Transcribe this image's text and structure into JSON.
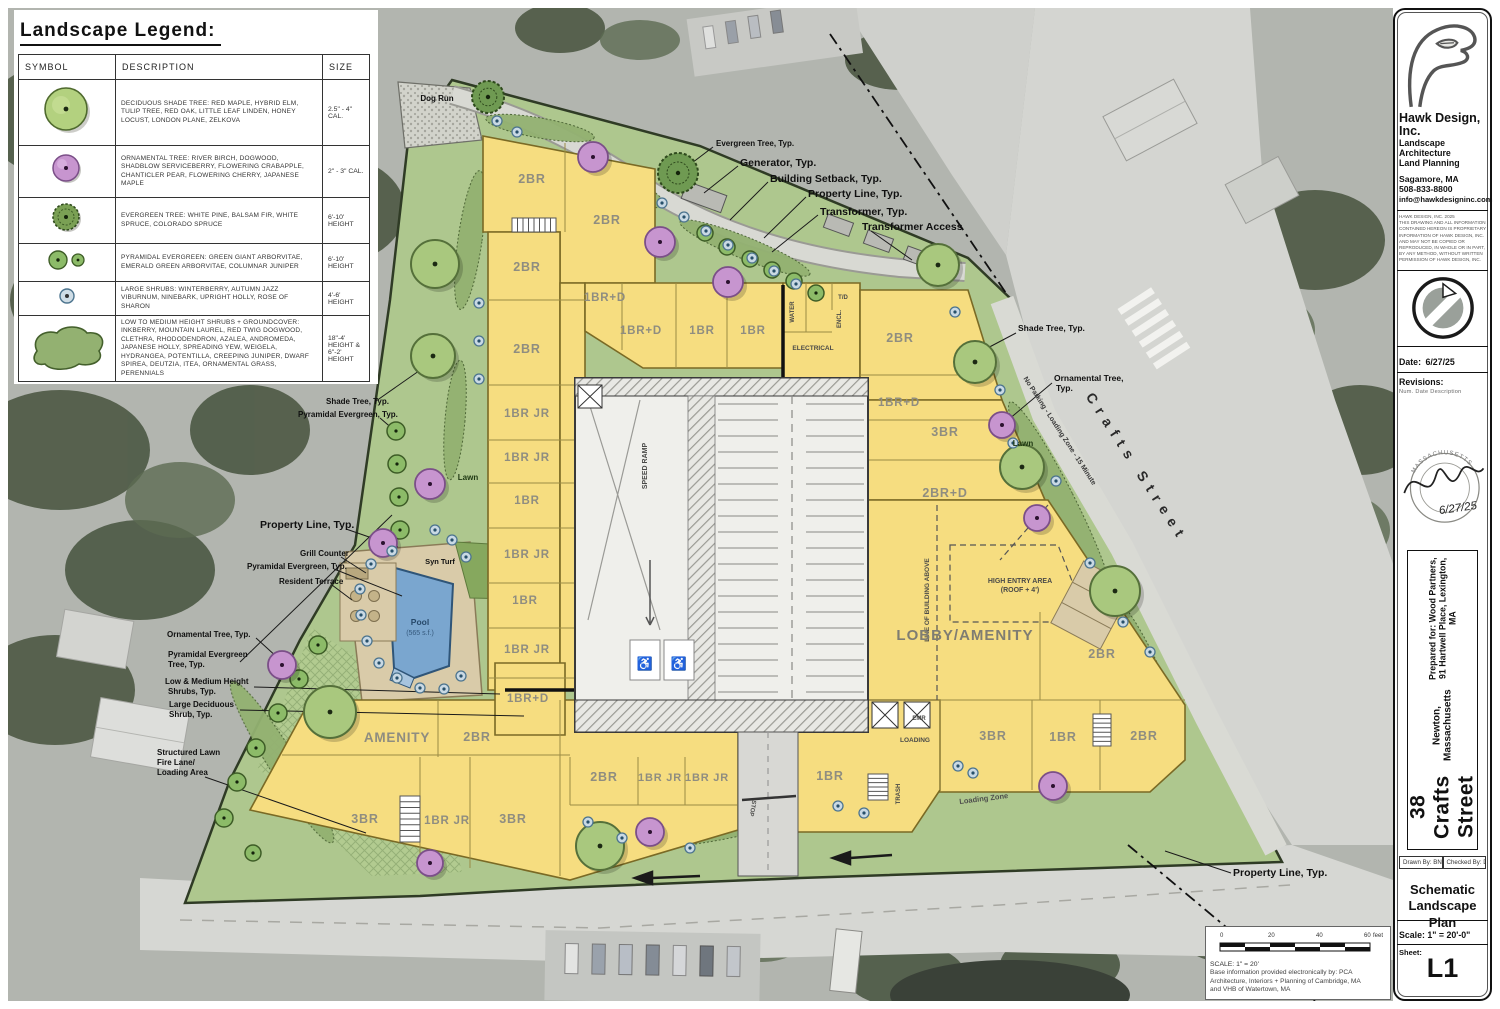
{
  "legend": {
    "title": "Landscape Legend:",
    "headers": [
      "SYMBOL",
      "DESCRIPTION",
      "SIZE"
    ],
    "rows": [
      {
        "desc": "DECIDUOUS SHADE TREE: RED MAPLE, HYBRID ELM, TULIP TREE, RED OAK, LITTLE LEAF LINDEN, HONEY LOCUST, LONDON PLANE, ZELKOVA",
        "size": "2.5\" - 4\" CAL."
      },
      {
        "desc": "ORNAMENTAL TREE: RIVER BIRCH, DOGWOOD, SHADBLOW SERVICEBERRY, FLOWERING CRABAPPLE, CHANTICLER PEAR, FLOWERING CHERRY, JAPANESE MAPLE",
        "size": "2\" - 3\" CAL."
      },
      {
        "desc": "EVERGREEN TREE: WHITE PINE, BALSAM FIR, WHITE SPRUCE, COLORADO SPRUCE",
        "size": "6'-10' HEIGHT"
      },
      {
        "desc": "PYRAMIDAL EVERGREEN: GREEN GIANT ARBORVITAE, EMERALD GREEN ARBORVITAE, COLUMNAR JUNIPER",
        "size": "6'-10' HEIGHT"
      },
      {
        "desc": "LARGE SHRUBS: WINTERBERRY, AUTUMN JAZZ VIBURNUM, NINEBARK, UPRIGHT HOLLY, ROSE OF SHARON",
        "size": "4'-6' HEIGHT"
      },
      {
        "desc": "LOW TO MEDIUM HEIGHT SHRUBS + GROUNDCOVER: INKBERRY, MOUNTAIN LAUREL, RED TWIG DOGWOOD, CLETHRA, RHODODENDRON, AZALEA, ANDROMEDA, JAPANESE HOLLY, SPREADING YEW, WEIGELA, HYDRANGEA, POTENTILLA, CREEPING JUNIPER, DWARF SPIREA, DEUTZIA, ITEA, ORNAMENTAL GRASS, PERENNIALS",
        "size": "18\"-4' HEIGHT & 6\"-2' HEIGHT"
      }
    ]
  },
  "titleblock": {
    "company": "Hawk Design, Inc.",
    "service1": "Landscape Architecture",
    "service2": "Land Planning",
    "city": "Sagamore, MA",
    "phone": "508-833-8800",
    "email": "info@hawkdesigninc.com",
    "copyright1": "HAWK DESIGN, INC. 2025",
    "copyright2": "THIS DRAWING AND ALL INFORMATION CONTAINED HEREON IS PROPRIETARY INFORMATION OF HAWK DESIGN, INC. AND MAY NOT BE COPIED OR REPRODUCED, IN WHOLE OR IN PART, BY ANY METHOD, WITHOUT WRITTEN PERMISSION OF HAWK DESIGN, INC.",
    "date_label": "Date:",
    "date": "6/27/25",
    "revisions_label": "Revisions:",
    "rev_cols": "Num.  Date    Description",
    "seal_state": "MASSACHUSETTS",
    "seal_date": "6/27/25",
    "project_title": "38 Crafts Street",
    "project_city": "Newton, Massachusetts",
    "prepared_for": "Prepared for: Wood Partners, 91 Hartwell Place, Lexington, MA",
    "drawn_by": "Drawn By: BNL",
    "checked_by": "Checked By: DH",
    "sheet_name1": "Schematic",
    "sheet_name2": "Landscape Plan",
    "scale": "Scale: 1\" = 20'-0\"",
    "sheet_label": "Sheet:",
    "sheet_number": "L1"
  },
  "scalebar": {
    "ticks": [
      "0",
      "20",
      "40",
      "60"
    ],
    "unit": "feet",
    "caption": "SCALE: 1\" = 20'",
    "note1": "Base information provided electronically by: PCA",
    "note2": "Architecture, Interiors + Planning of Cambridge, MA",
    "note3": "and VHB of Watertown, MA"
  },
  "colors": {
    "building_yellow": "#f6dd80",
    "site_green": "#aec78e",
    "pool_blue": "#7aa6cf",
    "ornamental_purple": "#c795cf",
    "shade_green": "#a9c87e",
    "evergreen_green": "#6f9a52",
    "shrub_blue": "#c9d9e4"
  },
  "plan": {
    "labels": [
      {
        "t": "Dog Run",
        "x": 437,
        "y": 101,
        "s": 8,
        "a": "middle"
      },
      {
        "t": "Evergreen Tree, Typ.",
        "x": 716,
        "y": 146,
        "s": 8
      },
      {
        "t": "Generator, Typ.",
        "x": 740,
        "y": 166,
        "s": 10.5
      },
      {
        "t": "Building Setback, Typ.",
        "x": 770,
        "y": 182,
        "s": 10.5
      },
      {
        "t": "Property Line, Typ.",
        "x": 808,
        "y": 197,
        "s": 10.5
      },
      {
        "t": "Transformer, Typ.",
        "x": 820,
        "y": 215,
        "s": 10.5
      },
      {
        "t": "Transformer Access",
        "x": 862,
        "y": 230,
        "s": 10.5
      },
      {
        "t": "Shade Tree, Typ.",
        "x": 1018,
        "y": 331,
        "s": 8.5
      },
      {
        "t": "Ornamental Tree,",
        "x": 1054,
        "y": 381,
        "s": 8.5
      },
      {
        "t": "Typ.",
        "x": 1056,
        "y": 391,
        "s": 8.5
      },
      {
        "t": "Lawn",
        "x": 1023,
        "y": 446,
        "s": 8,
        "cl": "lawn",
        "a": "middle"
      },
      {
        "t": "Shade Tree, Typ.",
        "x": 326,
        "y": 404,
        "s": 8
      },
      {
        "t": "Pyramidal Evergreen, Typ.",
        "x": 298,
        "y": 417,
        "s": 8
      },
      {
        "t": "Lawn",
        "x": 468,
        "y": 480,
        "s": 8,
        "cl": "lawn",
        "a": "middle"
      },
      {
        "t": "Property Line, Typ.",
        "x": 260,
        "y": 528,
        "s": 10.5
      },
      {
        "t": "Grill Counter",
        "x": 300,
        "y": 556,
        "s": 8
      },
      {
        "t": "Pyramidal Evergreen, Typ.",
        "x": 247,
        "y": 569,
        "s": 8
      },
      {
        "t": "Resident Terrace",
        "x": 279,
        "y": 584,
        "s": 8
      },
      {
        "t": "Ornamental Tree, Typ.",
        "x": 167,
        "y": 637,
        "s": 8
      },
      {
        "t": "Pyramidal Evergreen",
        "x": 168,
        "y": 657,
        "s": 8
      },
      {
        "t": "Tree, Typ.",
        "x": 168,
        "y": 667,
        "s": 8
      },
      {
        "t": "Low & Medium Height",
        "x": 165,
        "y": 684,
        "s": 8
      },
      {
        "t": "Shrubs, Typ.",
        "x": 168,
        "y": 694,
        "s": 8
      },
      {
        "t": "Large Deciduous",
        "x": 169,
        "y": 707,
        "s": 8
      },
      {
        "t": "Shrub, Typ.",
        "x": 169,
        "y": 717,
        "s": 8
      },
      {
        "t": "Structured Lawn",
        "x": 157,
        "y": 755,
        "s": 8
      },
      {
        "t": "Fire Lane/",
        "x": 157,
        "y": 765,
        "s": 8
      },
      {
        "t": "Loading Area",
        "x": 157,
        "y": 775,
        "s": 8
      },
      {
        "t": "Property Line, Typ.",
        "x": 1233,
        "y": 876,
        "s": 10.5
      },
      {
        "t": "Crafts Street",
        "x": 1133,
        "y": 470,
        "s": 14,
        "cl": "street",
        "r": 57,
        "ls": 7
      },
      {
        "t": "No Parking - Loading Zone - 15 Minute",
        "x": 1058,
        "y": 432,
        "s": 7,
        "cl": "curb",
        "r": 57
      },
      {
        "t": "Syn Turf",
        "x": 440,
        "y": 564,
        "s": 7.5,
        "a": "middle"
      },
      {
        "t": "Pool",
        "x": 420,
        "y": 625,
        "s": 8.5,
        "cl": "pool",
        "a": "middle"
      },
      {
        "t": "(565 s.f.)",
        "x": 420,
        "y": 635,
        "s": 7,
        "cl": "pool2",
        "a": "middle"
      },
      {
        "t": "SPEED RAMP",
        "x": 647,
        "y": 466,
        "s": 7,
        "cl": "room",
        "r": -90,
        "a": "middle"
      },
      {
        "t": "ELECTRICAL",
        "x": 813,
        "y": 350,
        "s": 6.5,
        "cl": "room",
        "a": "middle"
      },
      {
        "t": "WATER",
        "x": 794,
        "y": 312,
        "s": 6,
        "cl": "room",
        "r": -90,
        "a": "middle"
      },
      {
        "t": "T/D",
        "x": 843,
        "y": 299,
        "s": 6,
        "cl": "room",
        "a": "middle"
      },
      {
        "t": "ENCL.",
        "x": 841,
        "y": 319,
        "s": 6,
        "cl": "room",
        "r": -90,
        "a": "middle"
      },
      {
        "t": "EMR",
        "x": 919,
        "y": 720,
        "s": 6,
        "cl": "room",
        "a": "middle"
      },
      {
        "t": "LOADING",
        "x": 915,
        "y": 742,
        "s": 6.5,
        "cl": "room",
        "a": "middle"
      },
      {
        "t": "TRASH",
        "x": 900,
        "y": 794,
        "s": 6,
        "cl": "room",
        "r": -90,
        "a": "middle"
      },
      {
        "t": "HIGH ENTRY AREA",
        "x": 1020,
        "y": 583,
        "s": 7,
        "cl": "room",
        "a": "middle"
      },
      {
        "t": "(ROOF + 4')",
        "x": 1020,
        "y": 592,
        "s": 7,
        "cl": "room",
        "a": "middle"
      },
      {
        "t": "LINE OF BUILDING ABOVE",
        "x": 929,
        "y": 600,
        "s": 6.5,
        "cl": "room",
        "r": -90,
        "a": "middle"
      },
      {
        "t": "Loading Zone",
        "x": 984,
        "y": 801,
        "s": 7.5,
        "cl": "pave",
        "r": -7,
        "a": "middle"
      },
      {
        "t": "STOP",
        "x": 751,
        "y": 808,
        "s": 6,
        "cl": "pave",
        "r": 100,
        "a": "middle"
      },
      {
        "t": "2BR",
        "x": 532,
        "y": 183,
        "s": 12.5,
        "cl": "unit",
        "a": "middle"
      },
      {
        "t": "2BR",
        "x": 607,
        "y": 224,
        "s": 12.5,
        "cl": "unit",
        "a": "middle"
      },
      {
        "t": "2BR",
        "x": 527,
        "y": 271,
        "s": 12.5,
        "cl": "unit",
        "a": "middle"
      },
      {
        "t": "2BR",
        "x": 527,
        "y": 353,
        "s": 12.5,
        "cl": "unit",
        "a": "middle"
      },
      {
        "t": "1BR JR",
        "x": 527,
        "y": 417,
        "s": 11.5,
        "cl": "unit",
        "a": "middle"
      },
      {
        "t": "1BR JR",
        "x": 527,
        "y": 461,
        "s": 11.5,
        "cl": "unit",
        "a": "middle"
      },
      {
        "t": "1BR",
        "x": 527,
        "y": 504,
        "s": 11.5,
        "cl": "unit",
        "a": "middle"
      },
      {
        "t": "1BR JR",
        "x": 527,
        "y": 558,
        "s": 11.5,
        "cl": "unit",
        "a": "middle"
      },
      {
        "t": "1BR",
        "x": 525,
        "y": 604,
        "s": 11.5,
        "cl": "unit",
        "a": "middle"
      },
      {
        "t": "1BR JR",
        "x": 527,
        "y": 653,
        "s": 11.5,
        "cl": "unit",
        "a": "middle"
      },
      {
        "t": "1BR+D",
        "x": 528,
        "y": 702,
        "s": 11.5,
        "cl": "unit",
        "a": "middle"
      },
      {
        "t": "1BR+D",
        "x": 605,
        "y": 301,
        "s": 11.5,
        "cl": "unit",
        "a": "middle"
      },
      {
        "t": "1BR+D",
        "x": 641,
        "y": 334,
        "s": 11.5,
        "cl": "unit",
        "a": "middle"
      },
      {
        "t": "1BR",
        "x": 702,
        "y": 334,
        "s": 11.5,
        "cl": "unit",
        "a": "middle"
      },
      {
        "t": "1BR",
        "x": 753,
        "y": 334,
        "s": 11.5,
        "cl": "unit",
        "a": "middle"
      },
      {
        "t": "2BR",
        "x": 900,
        "y": 342,
        "s": 12.5,
        "cl": "unit",
        "a": "middle"
      },
      {
        "t": "1BR+D",
        "x": 899,
        "y": 406,
        "s": 11.5,
        "cl": "unit",
        "a": "middle"
      },
      {
        "t": "3BR",
        "x": 945,
        "y": 436,
        "s": 12.5,
        "cl": "unit",
        "a": "middle"
      },
      {
        "t": "2BR+D",
        "x": 945,
        "y": 497,
        "s": 12.5,
        "cl": "unit",
        "a": "middle"
      },
      {
        "t": "LOBBY/AMENITY",
        "x": 965,
        "y": 640,
        "s": 15,
        "cl": "unitbig",
        "a": "middle"
      },
      {
        "t": "2BR",
        "x": 1102,
        "y": 658,
        "s": 12.5,
        "cl": "unit",
        "a": "middle"
      },
      {
        "t": "AMENITY",
        "x": 397,
        "y": 742,
        "s": 13.5,
        "cl": "unit",
        "a": "middle"
      },
      {
        "t": "2BR",
        "x": 477,
        "y": 741,
        "s": 12.5,
        "cl": "unit",
        "a": "middle"
      },
      {
        "t": "3BR",
        "x": 365,
        "y": 823,
        "s": 12.5,
        "cl": "unit",
        "a": "middle"
      },
      {
        "t": "1BR JR",
        "x": 447,
        "y": 824,
        "s": 11.5,
        "cl": "unit",
        "a": "middle"
      },
      {
        "t": "3BR",
        "x": 513,
        "y": 823,
        "s": 12.5,
        "cl": "unit",
        "a": "middle"
      },
      {
        "t": "2BR",
        "x": 604,
        "y": 781,
        "s": 12.5,
        "cl": "unit",
        "a": "middle"
      },
      {
        "t": "1BR JR",
        "x": 660,
        "y": 781,
        "s": 11,
        "cl": "unit",
        "a": "middle"
      },
      {
        "t": "1BR JR",
        "x": 707,
        "y": 781,
        "s": 11,
        "cl": "unit",
        "a": "middle"
      },
      {
        "t": "1BR",
        "x": 830,
        "y": 780,
        "s": 12.5,
        "cl": "unit",
        "a": "middle"
      },
      {
        "t": "3BR",
        "x": 993,
        "y": 740,
        "s": 12.5,
        "cl": "unit",
        "a": "middle"
      },
      {
        "t": "1BR",
        "x": 1063,
        "y": 741,
        "s": 12.5,
        "cl": "unit",
        "a": "middle"
      },
      {
        "t": "2BR",
        "x": 1144,
        "y": 740,
        "s": 12.5,
        "cl": "unit",
        "a": "middle"
      }
    ],
    "trees": [
      {
        "t": "s",
        "x": 435,
        "y": 264,
        "r": 24
      },
      {
        "t": "s",
        "x": 433,
        "y": 356,
        "r": 22
      },
      {
        "t": "s",
        "x": 330,
        "y": 712,
        "r": 26
      },
      {
        "t": "s",
        "x": 600,
        "y": 846,
        "r": 24
      },
      {
        "t": "s",
        "x": 938,
        "y": 265,
        "r": 21
      },
      {
        "t": "s",
        "x": 975,
        "y": 362,
        "r": 21
      },
      {
        "t": "s",
        "x": 1022,
        "y": 467,
        "r": 22
      },
      {
        "t": "s",
        "x": 1115,
        "y": 591,
        "r": 25
      },
      {
        "t": "e",
        "x": 488,
        "y": 97,
        "r": 16
      },
      {
        "t": "e",
        "x": 678,
        "y": 173,
        "r": 20
      },
      {
        "t": "p",
        "x": 705,
        "y": 233,
        "r": 8
      },
      {
        "t": "p",
        "x": 727,
        "y": 247,
        "r": 8
      },
      {
        "t": "p",
        "x": 750,
        "y": 259,
        "r": 8
      },
      {
        "t": "p",
        "x": 772,
        "y": 270,
        "r": 8
      },
      {
        "t": "p",
        "x": 794,
        "y": 281,
        "r": 8
      },
      {
        "t": "p",
        "x": 816,
        "y": 293,
        "r": 8
      },
      {
        "t": "p",
        "x": 396,
        "y": 431,
        "r": 9
      },
      {
        "t": "p",
        "x": 397,
        "y": 464,
        "r": 9
      },
      {
        "t": "p",
        "x": 399,
        "y": 497,
        "r": 9
      },
      {
        "t": "p",
        "x": 400,
        "y": 530,
        "r": 9
      },
      {
        "t": "p",
        "x": 318,
        "y": 645,
        "r": 9
      },
      {
        "t": "p",
        "x": 299,
        "y": 679,
        "r": 9
      },
      {
        "t": "p",
        "x": 278,
        "y": 713,
        "r": 9
      },
      {
        "t": "p",
        "x": 256,
        "y": 748,
        "r": 9
      },
      {
        "t": "p",
        "x": 237,
        "y": 782,
        "r": 9
      },
      {
        "t": "p",
        "x": 224,
        "y": 818,
        "r": 9
      },
      {
        "t": "p",
        "x": 253,
        "y": 853,
        "r": 8
      },
      {
        "t": "o",
        "x": 593,
        "y": 157,
        "r": 15
      },
      {
        "t": "o",
        "x": 660,
        "y": 242,
        "r": 15
      },
      {
        "t": "o",
        "x": 728,
        "y": 282,
        "r": 15
      },
      {
        "t": "o",
        "x": 430,
        "y": 484,
        "r": 15
      },
      {
        "t": "o",
        "x": 383,
        "y": 543,
        "r": 14
      },
      {
        "t": "o",
        "x": 282,
        "y": 665,
        "r": 14
      },
      {
        "t": "o",
        "x": 1002,
        "y": 425,
        "r": 13
      },
      {
        "t": "o",
        "x": 1037,
        "y": 518,
        "r": 13
      },
      {
        "t": "o",
        "x": 650,
        "y": 832,
        "r": 14
      },
      {
        "t": "o",
        "x": 430,
        "y": 863,
        "r": 13
      },
      {
        "t": "o",
        "x": 1053,
        "y": 786,
        "r": 14
      },
      {
        "t": "b",
        "x": 497,
        "y": 121,
        "r": 5
      },
      {
        "t": "b",
        "x": 517,
        "y": 132,
        "r": 5
      },
      {
        "t": "b",
        "x": 662,
        "y": 203,
        "r": 5
      },
      {
        "t": "b",
        "x": 684,
        "y": 217,
        "r": 5
      },
      {
        "t": "b",
        "x": 706,
        "y": 231,
        "r": 5
      },
      {
        "t": "b",
        "x": 728,
        "y": 245,
        "r": 5
      },
      {
        "t": "b",
        "x": 752,
        "y": 258,
        "r": 5
      },
      {
        "t": "b",
        "x": 774,
        "y": 271,
        "r": 5
      },
      {
        "t": "b",
        "x": 796,
        "y": 284,
        "r": 5
      },
      {
        "t": "b",
        "x": 479,
        "y": 303,
        "r": 5
      },
      {
        "t": "b",
        "x": 479,
        "y": 341,
        "r": 5
      },
      {
        "t": "b",
        "x": 479,
        "y": 379,
        "r": 5
      },
      {
        "t": "b",
        "x": 392,
        "y": 551,
        "r": 5
      },
      {
        "t": "b",
        "x": 371,
        "y": 564,
        "r": 5
      },
      {
        "t": "b",
        "x": 360,
        "y": 589,
        "r": 5
      },
      {
        "t": "b",
        "x": 361,
        "y": 615,
        "r": 5
      },
      {
        "t": "b",
        "x": 367,
        "y": 641,
        "r": 5
      },
      {
        "t": "b",
        "x": 379,
        "y": 663,
        "r": 5
      },
      {
        "t": "b",
        "x": 397,
        "y": 678,
        "r": 5
      },
      {
        "t": "b",
        "x": 420,
        "y": 688,
        "r": 5
      },
      {
        "t": "b",
        "x": 444,
        "y": 689,
        "r": 5
      },
      {
        "t": "b",
        "x": 461,
        "y": 676,
        "r": 5
      },
      {
        "t": "b",
        "x": 466,
        "y": 557,
        "r": 5
      },
      {
        "t": "b",
        "x": 435,
        "y": 530,
        "r": 5
      },
      {
        "t": "b",
        "x": 452,
        "y": 540,
        "r": 5
      },
      {
        "t": "b",
        "x": 955,
        "y": 312,
        "r": 5
      },
      {
        "t": "b",
        "x": 1000,
        "y": 390,
        "r": 5
      },
      {
        "t": "b",
        "x": 1013,
        "y": 443,
        "r": 5
      },
      {
        "t": "b",
        "x": 1056,
        "y": 481,
        "r": 5
      },
      {
        "t": "b",
        "x": 1090,
        "y": 563,
        "r": 5
      },
      {
        "t": "b",
        "x": 1123,
        "y": 622,
        "r": 5
      },
      {
        "t": "b",
        "x": 1150,
        "y": 652,
        "r": 5
      },
      {
        "t": "b",
        "x": 588,
        "y": 822,
        "r": 5
      },
      {
        "t": "b",
        "x": 622,
        "y": 838,
        "r": 5
      },
      {
        "t": "b",
        "x": 690,
        "y": 848,
        "r": 5
      },
      {
        "t": "b",
        "x": 838,
        "y": 806,
        "r": 5
      },
      {
        "t": "b",
        "x": 864,
        "y": 813,
        "r": 5
      },
      {
        "t": "b",
        "x": 958,
        "y": 766,
        "r": 5
      },
      {
        "t": "b",
        "x": 973,
        "y": 773,
        "r": 5
      }
    ]
  }
}
